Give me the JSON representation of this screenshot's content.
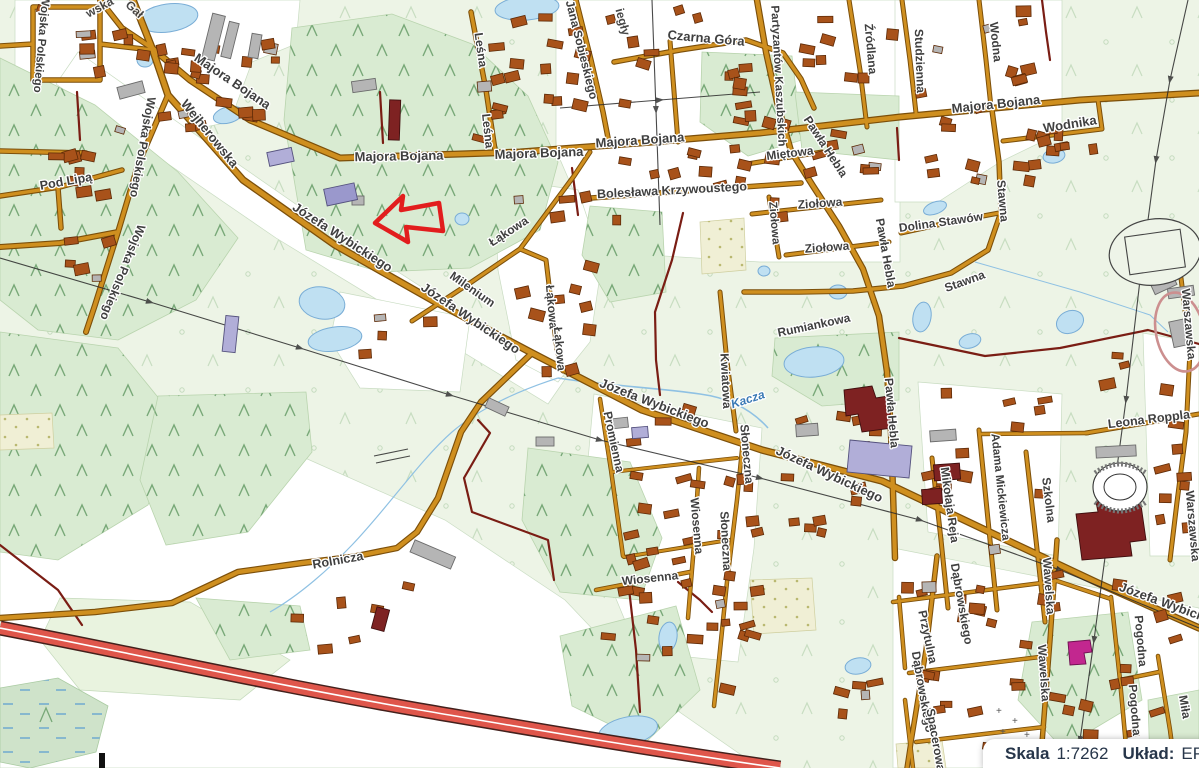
{
  "statusbar": {
    "scale_label": "Skala",
    "scale_value": "1:7262",
    "crs_label": "Układ:",
    "crs_value": "EPS"
  },
  "annotation": {
    "shape": "arrow-pointing-left",
    "color": "#e21d1d"
  },
  "map": {
    "colors": {
      "road_fill": "#cf8f1f",
      "road_casing": "#7c4f0a",
      "unpaved_road": "#7a1d14",
      "highway_fill": "#df564b",
      "highway_casing": "#43201c",
      "forest": "#d9ebd2",
      "open_land": "#e9f3df",
      "water": "#bfe0f2",
      "building": "#a8521a",
      "public_building_gray": "#b5b5b5",
      "public_building_darkred": "#7e2222",
      "public_building_lavender": "#b1aed8",
      "public_building_magenta": "#c2278f",
      "label_text": "#3f3f3f",
      "river_label": "#3a79b5"
    },
    "river_name": "Kacza",
    "street_labels": [
      {
        "text": "Wojska Polskiego",
        "x": 41,
        "y": 44,
        "rot": 95,
        "size": 11.5
      },
      {
        "text": "Wojska Polskiego",
        "x": 142,
        "y": 147,
        "rot": 100,
        "size": 12
      },
      {
        "text": "Wojska Polskiego",
        "x": 122,
        "y": 272,
        "rot": 112,
        "size": 12
      },
      {
        "text": "Pod Lipą",
        "x": 66,
        "y": 182,
        "rot": -10,
        "size": 12.5
      },
      {
        "text": "Wejherowska",
        "x": 209,
        "y": 134,
        "rot": 51,
        "size": 13
      },
      {
        "text": "Majora Bojana",
        "x": 232,
        "y": 82,
        "rot": 34,
        "size": 13
      },
      {
        "text": "Majora Bojana",
        "x": 399,
        "y": 157,
        "rot": -1,
        "size": 13
      },
      {
        "text": "Majora Bojana",
        "x": 539,
        "y": 154,
        "rot": -2,
        "size": 13
      },
      {
        "text": "Majora Bojana",
        "x": 640,
        "y": 141,
        "rot": -4,
        "size": 13
      },
      {
        "text": "Majora Bojana",
        "x": 996,
        "y": 105,
        "rot": -6,
        "size": 13
      },
      {
        "text": "Leśna",
        "x": 480,
        "y": 50,
        "rot": 82,
        "size": 12
      },
      {
        "text": "Leśna",
        "x": 487,
        "y": 131,
        "rot": 84,
        "size": 12
      },
      {
        "text": "Jana Sobieskiego",
        "x": 581,
        "y": 50,
        "rot": 76,
        "size": 12
      },
      {
        "text": "Czarna Góra",
        "x": 706,
        "y": 39,
        "rot": 5,
        "size": 13
      },
      {
        "text": "Bolesława Krzywoustego",
        "x": 672,
        "y": 191,
        "rot": -3,
        "size": 12.5
      },
      {
        "text": "Partyzantów Kaszubskich",
        "x": 778,
        "y": 76,
        "rot": 87,
        "size": 11.5
      },
      {
        "text": "Miętowa",
        "x": 790,
        "y": 154,
        "rot": -7,
        "size": 12
      },
      {
        "text": "Ziołowa",
        "x": 820,
        "y": 204,
        "rot": -4,
        "size": 12
      },
      {
        "text": "Ziołowa",
        "x": 827,
        "y": 248,
        "rot": -4,
        "size": 12
      },
      {
        "text": "Ziołowa",
        "x": 774,
        "y": 223,
        "rot": 85,
        "size": 11.5
      },
      {
        "text": "Pawła Hebla",
        "x": 825,
        "y": 147,
        "rot": 57,
        "size": 12
      },
      {
        "text": "Pawła Hebla",
        "x": 885,
        "y": 253,
        "rot": 80,
        "size": 12
      },
      {
        "text": "Pawła Hebla",
        "x": 891,
        "y": 413,
        "rot": 85,
        "size": 12
      },
      {
        "text": "Źródlana",
        "x": 870,
        "y": 49,
        "rot": 85,
        "size": 12
      },
      {
        "text": "Studzienna",
        "x": 919,
        "y": 61,
        "rot": 88,
        "size": 12
      },
      {
        "text": "Wodna",
        "x": 995,
        "y": 42,
        "rot": 84,
        "size": 12
      },
      {
        "text": "Wodnika",
        "x": 1070,
        "y": 125,
        "rot": -9,
        "size": 13
      },
      {
        "text": "Dolina Stawów",
        "x": 941,
        "y": 223,
        "rot": -8,
        "size": 12
      },
      {
        "text": "Stawna",
        "x": 1002,
        "y": 201,
        "rot": 85,
        "size": 12
      },
      {
        "text": "Stawna",
        "x": 965,
        "y": 282,
        "rot": -20,
        "size": 12
      },
      {
        "text": "Warszawska",
        "x": 1188,
        "y": 324,
        "rot": 85,
        "size": 12
      },
      {
        "text": "Warszawska",
        "x": 1192,
        "y": 526,
        "rot": 85,
        "size": 12
      },
      {
        "text": "Łąkowa",
        "x": 509,
        "y": 232,
        "rot": -33,
        "size": 12
      },
      {
        "text": "Łąkowa",
        "x": 551,
        "y": 307,
        "rot": 85,
        "size": 12
      },
      {
        "text": "Łąkowa",
        "x": 559,
        "y": 349,
        "rot": 85,
        "size": 12
      },
      {
        "text": "Milenium",
        "x": 472,
        "y": 290,
        "rot": 35,
        "size": 12
      },
      {
        "text": "Józefa Wybickiego",
        "x": 342,
        "y": 238,
        "rot": 33,
        "size": 13
      },
      {
        "text": "Józefa Wybickiego",
        "x": 470,
        "y": 319,
        "rot": 34,
        "size": 13
      },
      {
        "text": "Józefa Wybickiego",
        "x": 654,
        "y": 404,
        "rot": 21,
        "size": 13
      },
      {
        "text": "Józefa Wybickiego",
        "x": 829,
        "y": 475,
        "rot": 25,
        "size": 13
      },
      {
        "text": "Józefa Wybickiego",
        "x": 1174,
        "y": 607,
        "rot": 20,
        "size": 13
      },
      {
        "text": "Kacza",
        "x": 748,
        "y": 400,
        "rot": -18,
        "size": 12,
        "kind": "river"
      },
      {
        "text": "Kwiatowa",
        "x": 725,
        "y": 381,
        "rot": 87,
        "size": 12
      },
      {
        "text": "Rumiankowa",
        "x": 814,
        "y": 326,
        "rot": -12,
        "size": 12
      },
      {
        "text": "Promienna",
        "x": 613,
        "y": 442,
        "rot": 78,
        "size": 12
      },
      {
        "text": "Słoneczna",
        "x": 746,
        "y": 454,
        "rot": 85,
        "size": 12
      },
      {
        "text": "Słoneczna",
        "x": 725,
        "y": 541,
        "rot": 87,
        "size": 12
      },
      {
        "text": "Wiosenna",
        "x": 696,
        "y": 526,
        "rot": 85,
        "size": 12
      },
      {
        "text": "Wiosenna",
        "x": 650,
        "y": 579,
        "rot": -6,
        "size": 12
      },
      {
        "text": "Rolnicza",
        "x": 338,
        "y": 561,
        "rot": -10,
        "size": 12.5
      },
      {
        "text": "Mikołaja Reja",
        "x": 949,
        "y": 505,
        "rot": 82,
        "size": 12
      },
      {
        "text": "Adama Mickiewicza",
        "x": 1000,
        "y": 487,
        "rot": 84,
        "size": 11.5
      },
      {
        "text": "Szkolna",
        "x": 1048,
        "y": 500,
        "rot": 83,
        "size": 12
      },
      {
        "text": "Leona Roppla",
        "x": 1149,
        "y": 420,
        "rot": -7,
        "size": 12.5
      },
      {
        "text": "Dąbrowskiego",
        "x": 961,
        "y": 604,
        "rot": 80,
        "size": 12
      },
      {
        "text": "Dąbrowskiego",
        "x": 922,
        "y": 692,
        "rot": 80,
        "size": 12
      },
      {
        "text": "Przytulna",
        "x": 927,
        "y": 637,
        "rot": 78,
        "size": 12
      },
      {
        "text": "Spacerowa",
        "x": 935,
        "y": 740,
        "rot": 80,
        "size": 12
      },
      {
        "text": "Wawelska",
        "x": 1048,
        "y": 586,
        "rot": 86,
        "size": 12
      },
      {
        "text": "Wawelska",
        "x": 1043,
        "y": 673,
        "rot": 86,
        "size": 12
      },
      {
        "text": "Pogodna",
        "x": 1140,
        "y": 641,
        "rot": 85,
        "size": 12
      },
      {
        "text": "Pogodna",
        "x": 1134,
        "y": 710,
        "rot": 85,
        "size": 12
      },
      {
        "text": "Miła",
        "x": 1184,
        "y": 707,
        "rot": 80,
        "size": 12
      },
      {
        "text": "iegły",
        "x": 622,
        "y": 22,
        "rot": 75,
        "size": 12,
        "kind": "fragment"
      },
      {
        "text": "wska",
        "x": 100,
        "y": 8,
        "rot": -28,
        "size": 12,
        "kind": "fragment"
      },
      {
        "text": "Gał",
        "x": 134,
        "y": 10,
        "rot": 42,
        "size": 12,
        "kind": "fragment"
      }
    ]
  }
}
